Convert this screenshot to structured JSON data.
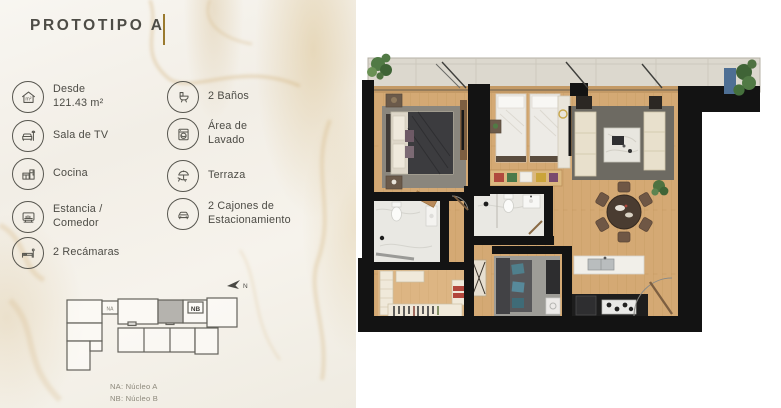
{
  "title": {
    "text": "PROTOTIPO A"
  },
  "features": {
    "area_icon_text": "m²",
    "column1": [
      {
        "icon": "area-icon",
        "lines": [
          "Desde",
          "121.43 m²"
        ]
      },
      {
        "icon": "tv-room-icon",
        "lines": [
          "Sala de TV"
        ]
      },
      {
        "icon": "kitchen-icon",
        "lines": [
          "Cocina"
        ]
      },
      {
        "icon": "dining-icon",
        "lines": [
          "Estancia /",
          "Comedor"
        ]
      },
      {
        "icon": "bedroom-icon",
        "lines": [
          "2 Recámaras"
        ]
      }
    ],
    "column2": [
      {
        "icon": "bathroom-icon",
        "lines": [
          "2 Baños"
        ]
      },
      {
        "icon": "laundry-icon",
        "lines": [
          "Área de",
          "Lavado"
        ]
      },
      {
        "icon": "terrace-icon",
        "lines": [
          "Terraza"
        ]
      },
      {
        "icon": "parking-icon",
        "lines": [
          "2 Cajones de",
          "Estacionamiento"
        ]
      }
    ]
  },
  "keyplan": {
    "north_label": "N",
    "na_label": "NA",
    "nb_label": "NB",
    "legend_line1": "NA: Núcleo A",
    "legend_line2": "NB: Núcleo B"
  },
  "colors": {
    "accent_gold": "#9a7a2e",
    "text": "#4c4b45",
    "marble_background": "#f3f0e9",
    "plan_wall": "#131313",
    "wood_floor": "#d4a974",
    "terrace_concrete": "#dcd8ce",
    "living_rug": "#6d6a62",
    "bedroom_rug": "#8a867d",
    "sofa_cream": "#e8e0cc",
    "accent_teal": "#4f7f8c",
    "plant_green": "#4e7743",
    "keyplan_highlight": "#b5b3ae"
  }
}
